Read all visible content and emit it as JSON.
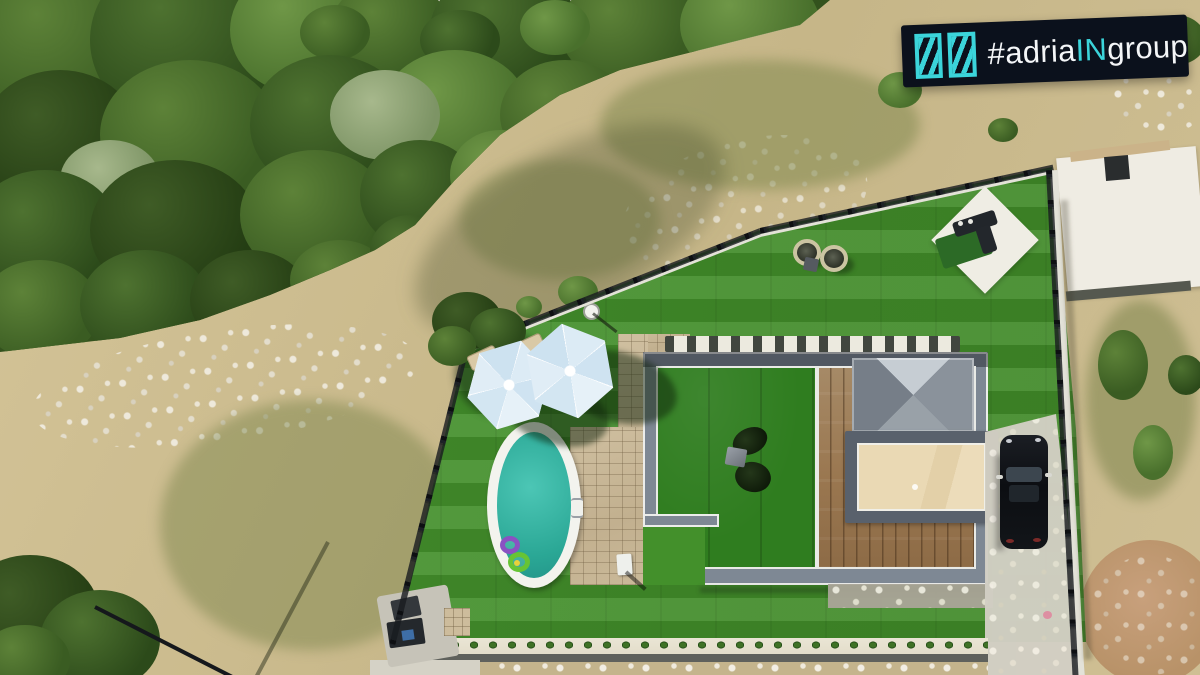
{
  "watermark": {
    "prefix": "#adria",
    "accent_text": "IN",
    "suffix": "group",
    "background": "#0b111c",
    "accent_color": "#3bd4da",
    "text_color": "#f4f6f8",
    "logo": "double-square-shutter-mark"
  },
  "palette": {
    "forest_green": "#3a5c22",
    "scrub_tan": "#cdbd92",
    "rock_white": "#e6e2d6",
    "lawn_green": "#44912c",
    "courtyard_green": "#2f7d1f",
    "pool_water": "#35b5a3",
    "pool_rim": "#f3f3ee",
    "umbrella_blue": "#d9e9f4",
    "paver_beige": "#c7b697",
    "house_frame_gray": "#7e8894",
    "deck_wood": "#9b7a55",
    "skylight_gray": "#9aa2ab",
    "annex_plywood": "#ead9b4",
    "car_black": "#121519",
    "driveway_gray": "#d2cfc4",
    "hedge_green": "#2f5a20",
    "white_pad": "#efede4"
  },
  "scene": {
    "description": "Aerial drone photo of a modern villa plot: artificial-turf yard with oval pool, two light-blue parasols, stone patio, flat-roof house with courtyard turf, wooden deck, pyramid skylight and plywood annex roof, white lounge pad, black car on a concrete driveway, surrounded by forest and dry scrubland.",
    "objects": [
      {
        "id": "forest",
        "label": "dense forest"
      },
      {
        "id": "rocky-outcrop",
        "label": "white rock outcrop"
      },
      {
        "id": "scrubland",
        "label": "dry scrub hillside"
      },
      {
        "id": "neighbor-foundation",
        "label": "neighbouring concrete slab"
      },
      {
        "id": "boundary-fence",
        "label": "black boundary fence"
      },
      {
        "id": "lawn",
        "label": "artificial turf lawn"
      },
      {
        "id": "hedge-row",
        "label": "row of young hedge plants"
      },
      {
        "id": "access-road",
        "label": "road below the plot"
      },
      {
        "id": "patio-pavers",
        "label": "beige stone paver patio"
      },
      {
        "id": "swimming-pool",
        "label": "oval swimming pool"
      },
      {
        "id": "pool-floats",
        "label": "swim rings in pool"
      },
      {
        "id": "sun-umbrellas",
        "label": "two light blue parasols"
      },
      {
        "id": "sun-loungers",
        "label": "sun loungers"
      },
      {
        "id": "villa-roof",
        "label": "flat-roof villa with parapet"
      },
      {
        "id": "courtyard-turf",
        "label": "green turf terrace"
      },
      {
        "id": "wood-deck",
        "label": "wooden deck"
      },
      {
        "id": "skylight",
        "label": "pyramid skylight"
      },
      {
        "id": "annex-roof",
        "label": "plywood annex roof"
      },
      {
        "id": "white-lounge-pad",
        "label": "white diamond lounge pad"
      },
      {
        "id": "round-chairs",
        "label": "two round garden chairs"
      },
      {
        "id": "driveway",
        "label": "concrete driveway"
      },
      {
        "id": "parked-car",
        "label": "black parked car"
      },
      {
        "id": "utility-corner",
        "label": "pool equipment corner"
      },
      {
        "id": "watermark",
        "label": "agency watermark"
      }
    ]
  }
}
